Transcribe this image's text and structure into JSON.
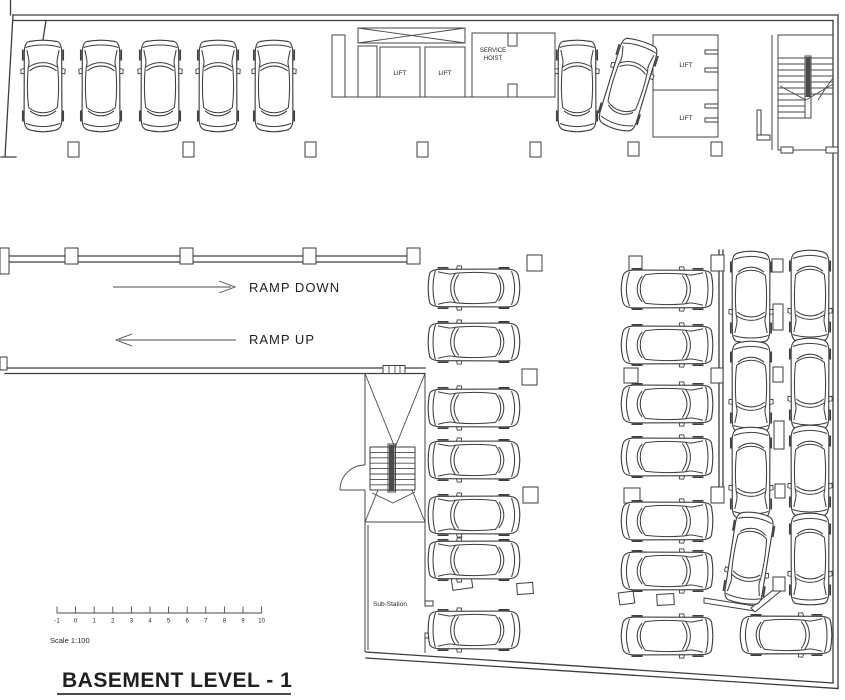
{
  "drawing": {
    "title": "BASEMENT LEVEL - 1",
    "scale_label": "Scale 1:100"
  },
  "labels": {
    "lift": "LIFT",
    "service_hoist_line1": "SERVICE",
    "service_hoist_line2": "HOIST",
    "ramp_down": "RAMP DOWN",
    "ramp_up": "RAMP UP",
    "sub_station": "Sub-Station"
  },
  "scale_bar": {
    "ticks": [
      "-1",
      "0",
      "1",
      "2",
      "3",
      "4",
      "5",
      "6",
      "7",
      "8",
      "9",
      "10"
    ],
    "start_x": 57,
    "spacing": 18.6,
    "line_y": 613
  },
  "colors": {
    "line": "#3d3d3d",
    "text": "#1f1f1f",
    "background": "#ffffff"
  },
  "floorplan": {
    "parking_spaces_shown": 30,
    "cars": [
      [
        43,
        86,
        0
      ],
      [
        101,
        86,
        0
      ],
      [
        160,
        86,
        0
      ],
      [
        218,
        86,
        0
      ],
      [
        274,
        86,
        0
      ],
      [
        577,
        86,
        0
      ],
      [
        628,
        85,
        17
      ],
      [
        474,
        288,
        270
      ],
      [
        474,
        342,
        270
      ],
      [
        474,
        408,
        270
      ],
      [
        474,
        460,
        270
      ],
      [
        474,
        515,
        270
      ],
      [
        474,
        560,
        270
      ],
      [
        474,
        630,
        270
      ],
      [
        667,
        289,
        90
      ],
      [
        667,
        345,
        90
      ],
      [
        667,
        404,
        90
      ],
      [
        667,
        457,
        90
      ],
      [
        667,
        521,
        90
      ],
      [
        667,
        571,
        90
      ],
      [
        667,
        636,
        90
      ],
      [
        751,
        297,
        180
      ],
      [
        751,
        387,
        180
      ],
      [
        751,
        473,
        180
      ],
      [
        749,
        558,
        189
      ],
      [
        810,
        296,
        180
      ],
      [
        810,
        384,
        180
      ],
      [
        810,
        471,
        180
      ],
      [
        810,
        559,
        180
      ],
      [
        786,
        635,
        90
      ]
    ],
    "columns": [
      [
        68,
        142,
        11,
        15
      ],
      [
        183,
        142,
        11,
        15
      ],
      [
        305,
        142,
        11,
        15
      ],
      [
        417,
        142,
        11,
        15
      ],
      [
        530,
        142,
        11,
        15
      ],
      [
        628,
        142,
        11,
        14
      ],
      [
        711,
        142,
        11,
        14
      ],
      [
        781,
        147,
        12,
        6
      ],
      [
        826,
        147,
        12,
        6
      ],
      [
        757,
        110,
        4,
        28
      ],
      [
        757,
        135,
        13,
        5
      ],
      [
        0,
        248,
        9,
        26
      ],
      [
        65,
        248,
        13,
        16
      ],
      [
        180,
        248,
        13,
        16
      ],
      [
        303,
        248,
        13,
        16
      ],
      [
        407,
        248,
        13,
        16
      ],
      [
        0,
        357,
        7,
        13
      ],
      [
        527,
        255,
        15,
        16
      ],
      [
        629,
        256,
        13,
        15
      ],
      [
        711,
        255,
        13,
        16
      ],
      [
        522,
        369,
        15,
        16
      ],
      [
        624,
        368,
        14,
        15
      ],
      [
        711,
        368,
        12,
        15
      ],
      [
        523,
        487,
        15,
        16
      ],
      [
        624,
        488,
        16,
        15
      ],
      [
        711,
        487,
        13,
        16
      ],
      [
        772,
        259,
        11,
        13
      ],
      [
        773,
        304,
        10,
        26
      ],
      [
        773,
        367,
        10,
        15
      ],
      [
        774,
        421,
        10,
        28
      ],
      [
        775,
        484,
        10,
        14
      ],
      [
        773,
        577,
        12,
        14
      ],
      [
        452,
        577,
        20,
        12,
        -8
      ],
      [
        517,
        583,
        16,
        11,
        -4
      ],
      [
        619,
        592,
        15,
        12,
        -8
      ],
      [
        657,
        594,
        17,
        11,
        -3
      ]
    ]
  }
}
